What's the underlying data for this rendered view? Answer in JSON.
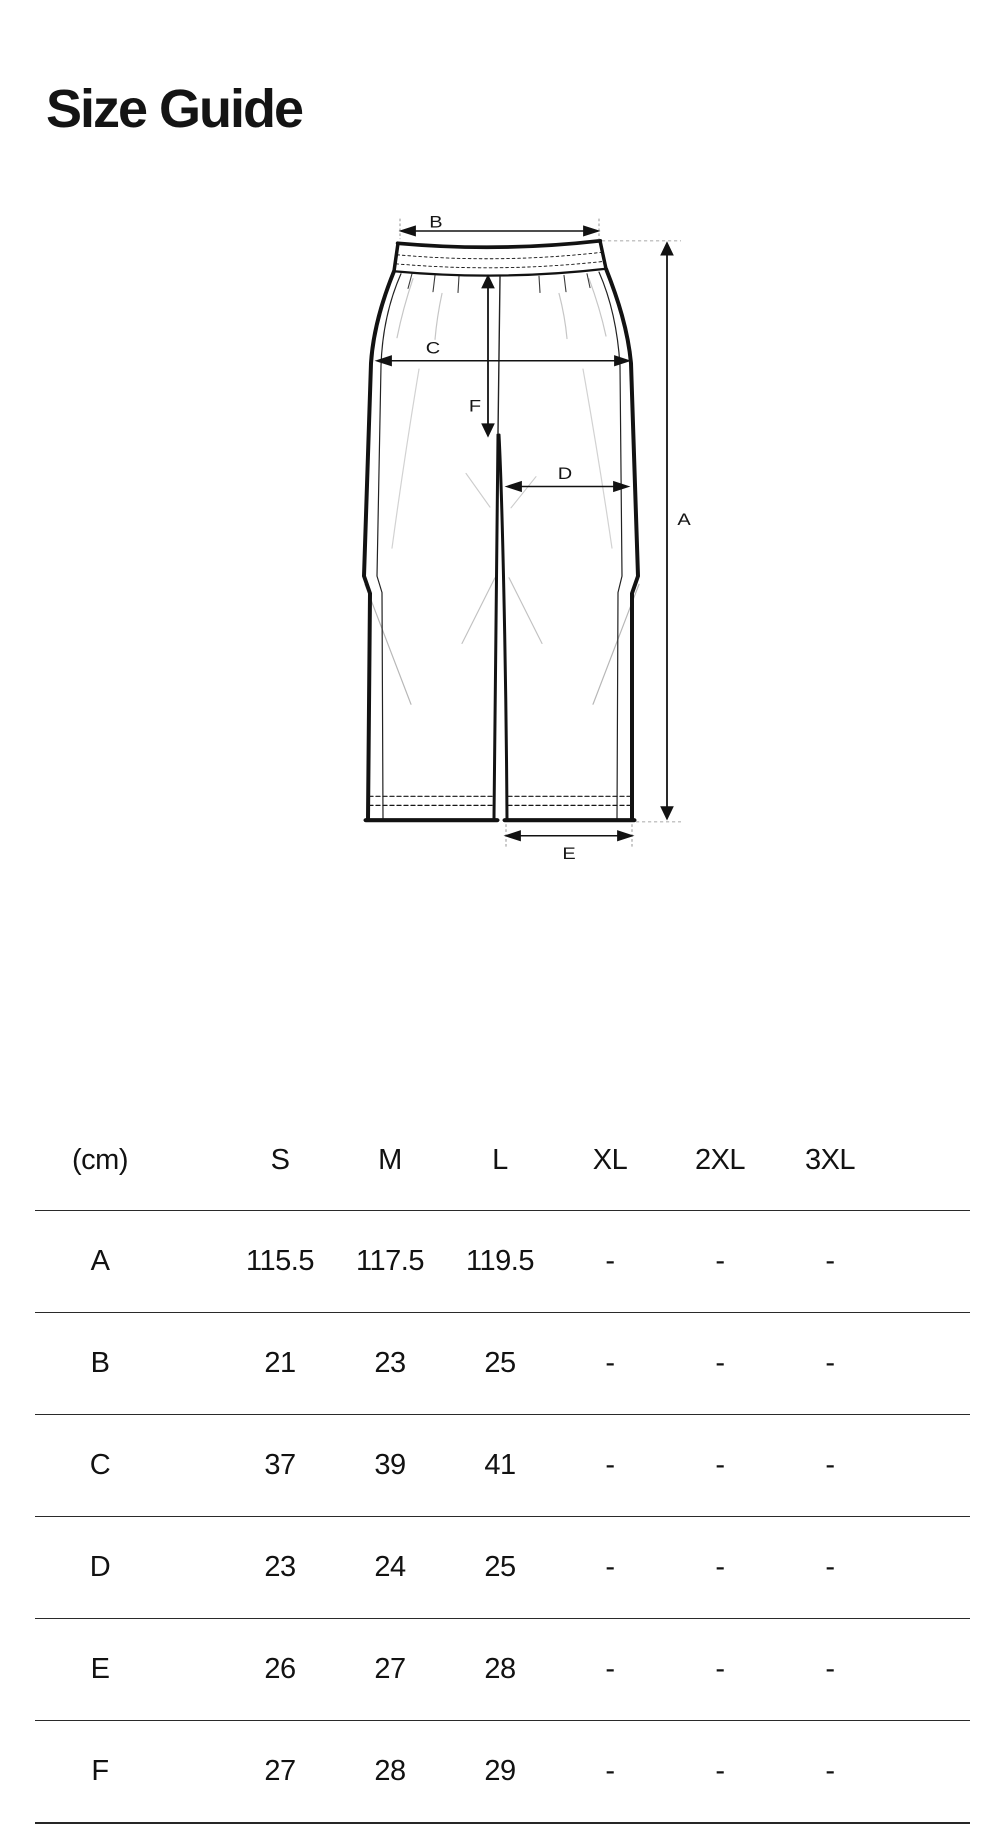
{
  "page": {
    "title": "Size Guide"
  },
  "diagram": {
    "kind": "pants-flat-sketch-with-measurements",
    "labels": {
      "a": "A",
      "b": "B",
      "c": "C",
      "d": "D",
      "e": "E",
      "f": "F"
    },
    "colors": {
      "ink": "#121212",
      "guide": "#b3b3b3",
      "crease": "#c6c6c6"
    }
  },
  "table": {
    "unit_label": "(cm)",
    "columns": [
      "S",
      "M",
      "L",
      "XL",
      "2XL",
      "3XL"
    ],
    "rows": [
      {
        "label": "A",
        "values": [
          "115.5",
          "117.5",
          "119.5",
          "-",
          "-",
          "-"
        ]
      },
      {
        "label": "B",
        "values": [
          "21",
          "23",
          "25",
          "-",
          "-",
          "-"
        ]
      },
      {
        "label": "C",
        "values": [
          "37",
          "39",
          "41",
          "-",
          "-",
          "-"
        ]
      },
      {
        "label": "D",
        "values": [
          "23",
          "24",
          "25",
          "-",
          "-",
          "-"
        ]
      },
      {
        "label": "E",
        "values": [
          "26",
          "27",
          "28",
          "-",
          "-",
          "-"
        ]
      },
      {
        "label": "F",
        "values": [
          "27",
          "28",
          "29",
          "-",
          "-",
          "-"
        ]
      }
    ]
  }
}
